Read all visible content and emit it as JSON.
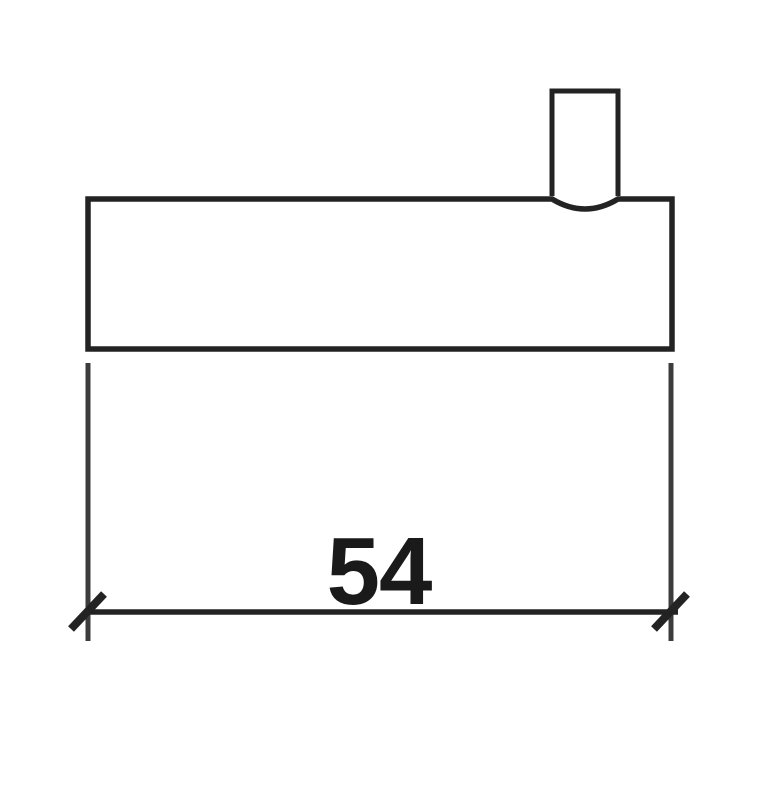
{
  "figure": {
    "type": "technical-drawing",
    "description": "Cross-section outline of a wide rectangular part with a small open-bottomed peg/tab protruding from its top right edge; an overall-width dimension line with oblique tick terminators runs below the part",
    "dimension": {
      "value": "54"
    },
    "colors": {
      "line": "#232323",
      "extension_line": "#3c3c3c",
      "text": "#1a1a1a",
      "background": "#ffffff"
    }
  }
}
